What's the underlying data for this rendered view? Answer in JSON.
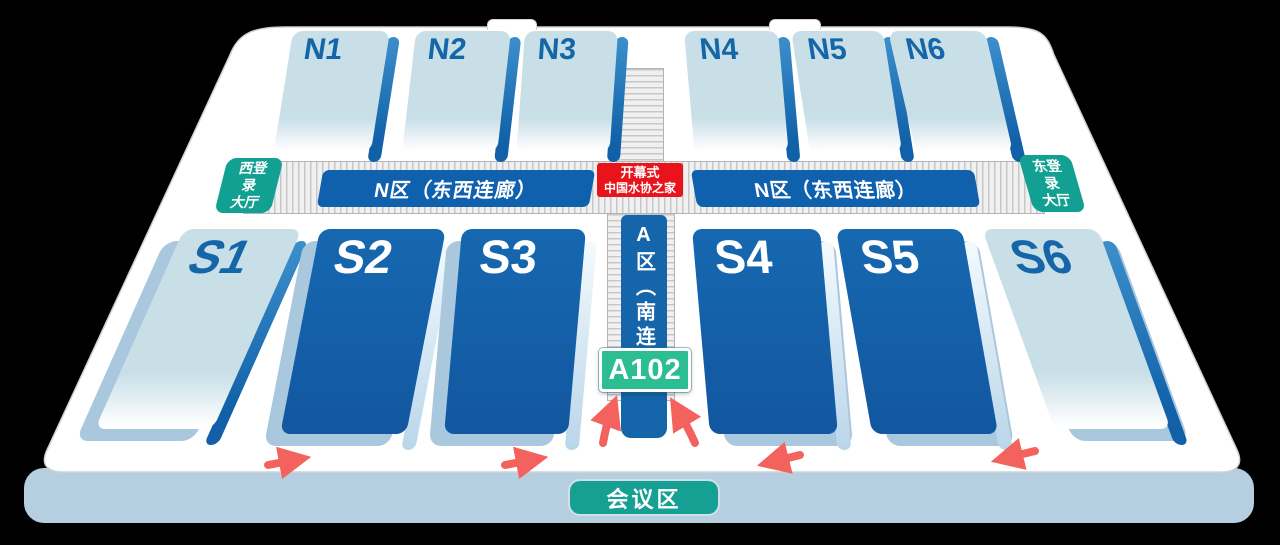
{
  "map": {
    "halls": {
      "north": [
        {
          "label": "N1"
        },
        {
          "label": "N2"
        },
        {
          "label": "N3"
        },
        {
          "label": "N4"
        },
        {
          "label": "N5"
        },
        {
          "label": "N6"
        }
      ],
      "south": [
        {
          "label": "S1"
        },
        {
          "label": "S2"
        },
        {
          "label": "S3"
        },
        {
          "label": "S4"
        },
        {
          "label": "S5"
        },
        {
          "label": "S6"
        }
      ]
    },
    "corridors": {
      "north_west_label": "N区（东西连廊）",
      "north_east_label": "N区（东西连廊）",
      "south_vertical_label": "A区（南连"
    },
    "center_banner": {
      "line1": "开幕式",
      "line2": "中国水协之家"
    },
    "entrances": {
      "west": {
        "line1": "西登",
        "line2": "录",
        "line3": "大厅"
      },
      "east": {
        "line1": "东登",
        "line2": "录",
        "line3": "大厅"
      }
    },
    "room_badge": {
      "label": "A102"
    },
    "conference_area": {
      "label": "会议区"
    }
  },
  "colors": {
    "hall_dark_blue": "#1461a8",
    "hall_light_blue": "#c9dfe8",
    "corridor_label_blue": "#1061ad",
    "entrance_teal": "#11a092",
    "banner_red": "#e9141b",
    "badge_green": "#2cbe92",
    "arrow_red": "#f4625e",
    "base_platform": "#b6cfe0"
  }
}
